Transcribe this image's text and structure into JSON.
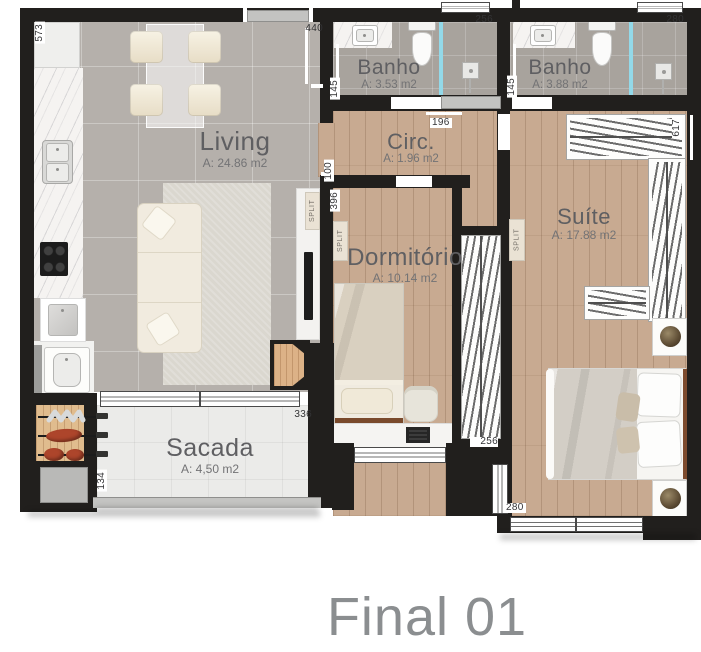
{
  "title": "Final 01",
  "rooms": {
    "living": {
      "name": "Living",
      "area": "A: 24.86 m2"
    },
    "banho1": {
      "name": "Banho",
      "area": "A: 3.53 m2"
    },
    "banho2": {
      "name": "Banho",
      "area": "A: 3.88 m2"
    },
    "circ": {
      "name": "Circ.",
      "area": "A: 1.96 m2"
    },
    "dormitorio": {
      "name": "Dormitório",
      "area": "A: 10.14 m2"
    },
    "suite": {
      "name": "Suíte",
      "area": "A: 17.88 m2"
    },
    "sacada": {
      "name": "Sacada",
      "area": "A: 4,50 m2"
    }
  },
  "dims": {
    "d573": "573",
    "d440": "440",
    "d256_banho1": "256",
    "d280_banho2": "280",
    "d145_banho1": "145",
    "d145_banho2": "145",
    "d196": "196",
    "d100": "100",
    "d396": "396",
    "d617": "617",
    "d256_wardrobe": "256",
    "d280_suite": "280",
    "d336": "336",
    "d134": "134"
  },
  "labels": {
    "split": "SPLIT"
  },
  "colors": {
    "wall": "#211f1d",
    "wood_floor": "#c8aa91",
    "tile_floor": "#b5b0ab",
    "bath_floor": "#a8a39d",
    "balcony_floor": "#ebebe9",
    "shower_glass": "#93d9e9",
    "room_text": "#5f5f62",
    "title_text": "#8b8e90"
  }
}
